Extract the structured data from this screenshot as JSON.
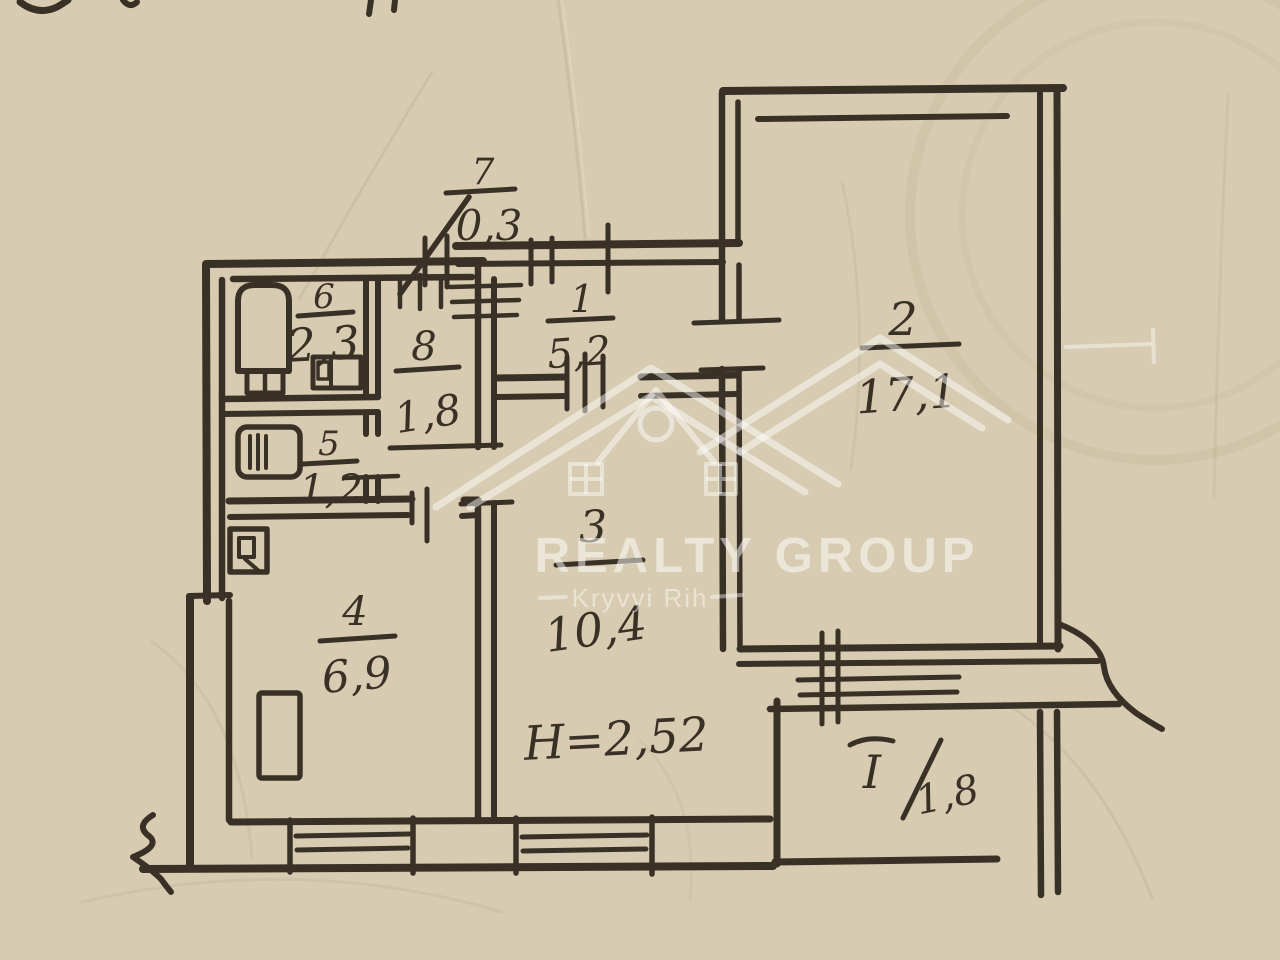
{
  "plan": {
    "rooms": [
      {
        "number": "1",
        "area": "5,2"
      },
      {
        "number": "2",
        "area": "17,1"
      },
      {
        "number": "3",
        "area": "10,4"
      },
      {
        "number": "4",
        "area": "6,9"
      },
      {
        "number": "5",
        "area": "1,2"
      },
      {
        "number": "6",
        "area": "2,3"
      },
      {
        "number": "7",
        "area": "0,3"
      },
      {
        "number": "8",
        "area": "1,8"
      }
    ],
    "balcony": {
      "label": "I",
      "area": "1,8"
    },
    "ceiling_height": "H=2,52"
  },
  "watermark": {
    "brand": "REALTY GROUP",
    "city": "Kryvyi Rih"
  },
  "colors": {
    "paper": "#d7ccb1",
    "ink": "#3a3126",
    "watermark_white": "rgba(255,255,255,0.5)"
  }
}
